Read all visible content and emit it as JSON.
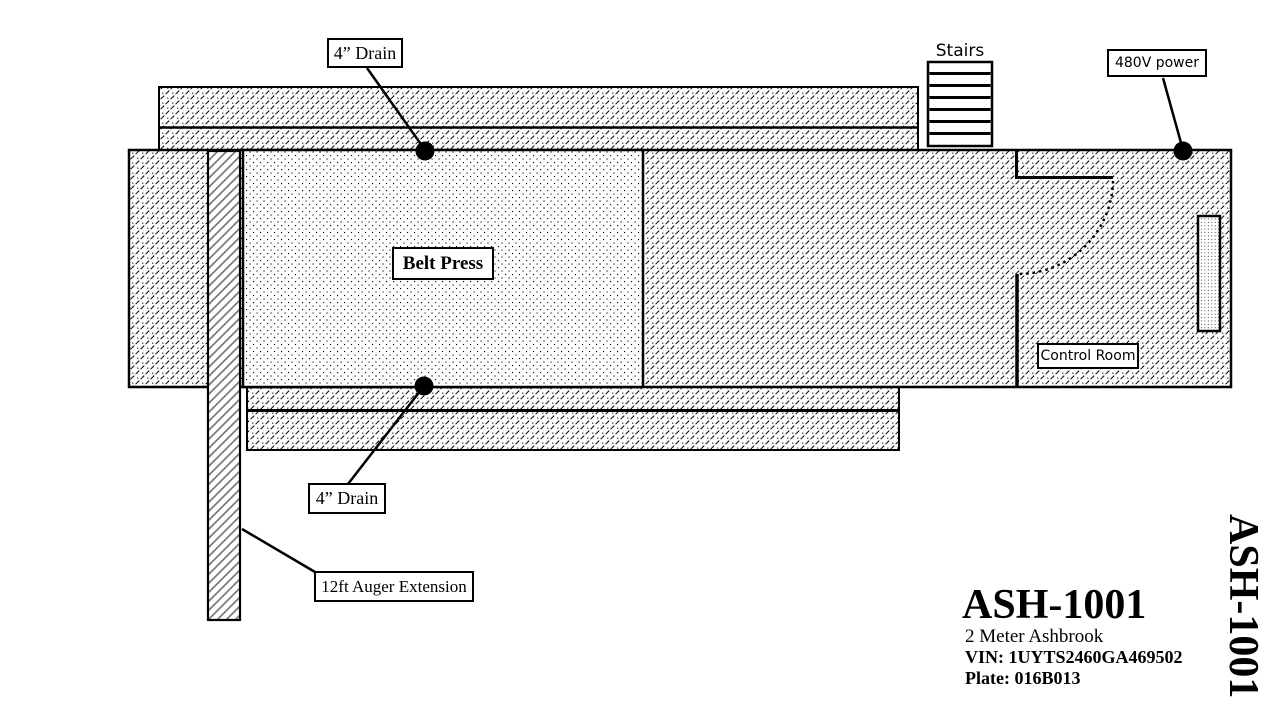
{
  "callouts": {
    "drain_top": {
      "label": "4” Drain"
    },
    "drain_bottom": {
      "label": "4” Drain"
    },
    "power": {
      "label": "480V power"
    },
    "auger": {
      "label": "12ft Auger Extension"
    }
  },
  "areas": {
    "belt_press": {
      "label": "Belt Press"
    },
    "control_room": {
      "label": "Control Room"
    },
    "stairs": {
      "label": "Stairs"
    }
  },
  "title_block": {
    "model": "ASH-1001",
    "description": "2 Meter Ashbrook",
    "vin": "VIN: 1UYTS2460GA469502",
    "plate": "Plate: 016B013"
  },
  "side_label": "ASH-1001",
  "colors": {
    "ink": "#000000",
    "paper": "#ffffff",
    "auger_stripe": "#7a7a7a"
  }
}
